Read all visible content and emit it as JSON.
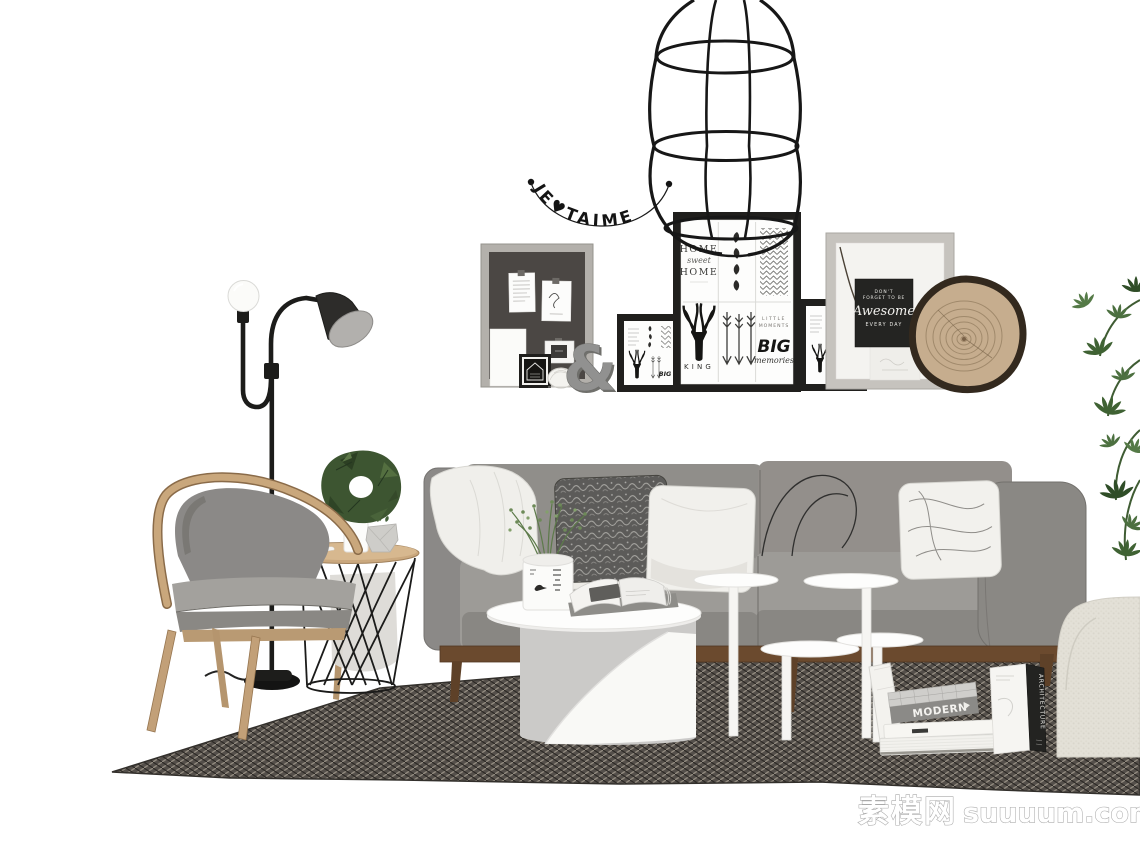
{
  "scene": {
    "type": "3d-furniture-render",
    "description": "Scandinavian style living room furniture set rendered on a white background",
    "background": "#ffffff"
  },
  "watermark": {
    "brand": "素模网",
    "domain": "suuuum.com"
  },
  "garland": {
    "text": "JE♥TAIME"
  },
  "posters": {
    "home": {
      "l1": "HOME",
      "l2": "sweet",
      "l3": "HOME"
    },
    "king_label": "KING",
    "big": {
      "l1": "LITTLE",
      "l2": "MOMENTS",
      "l3": "BIG",
      "l4": "memories"
    },
    "awesome": {
      "l1": "DON'T",
      "l2": "FORGET TO BE",
      "l3": "Awesome",
      "l4": "EVERY DAY"
    }
  },
  "decor": {
    "ampersand": "&"
  },
  "books": {
    "modern": "MODERN",
    "architecture": "ARCHITECTURE"
  },
  "objects": [
    "wire-cage-pendant-lamp",
    "love-letter-garland",
    "pin-board",
    "black-photo-frames",
    "chalkboard-awesome-print",
    "wood-slice-decor",
    "double-arm-floor-lamp",
    "wooden-armchair",
    "wire-basket-side-table",
    "green-wreath",
    "gray-fabric-sofa",
    "throw-pillows",
    "white-throw-blanket",
    "white-round-coffee-table",
    "white-nesting-side-tables",
    "potted-sprig-plant",
    "open-magazine",
    "book-stack",
    "modern-book",
    "architecture-book",
    "woven-area-rug",
    "cream-boucle-armchair",
    "hanging-green-plant",
    "shell-decor",
    "ampersand-letter",
    "white-bird-figurine"
  ],
  "colors": {
    "background": "#ffffff",
    "sofa_gray": "#908e8a",
    "sofa_seat": "#9d9b97",
    "wood_light": "#c9a77c",
    "wood_dark": "#6b4a2e",
    "rug_base": "#544f4a",
    "frame_black": "#201f1d",
    "frame_gray": "#c6c3be",
    "pinboard_gray": "#4b4744",
    "wreath_green": "#3d5531",
    "plant_green": "#4c7040",
    "wood_slice": "#c6ad8e",
    "cream": "#e3e0d7",
    "metal_black": "#1c1c1a",
    "white_furniture": "#fdfdfc"
  }
}
